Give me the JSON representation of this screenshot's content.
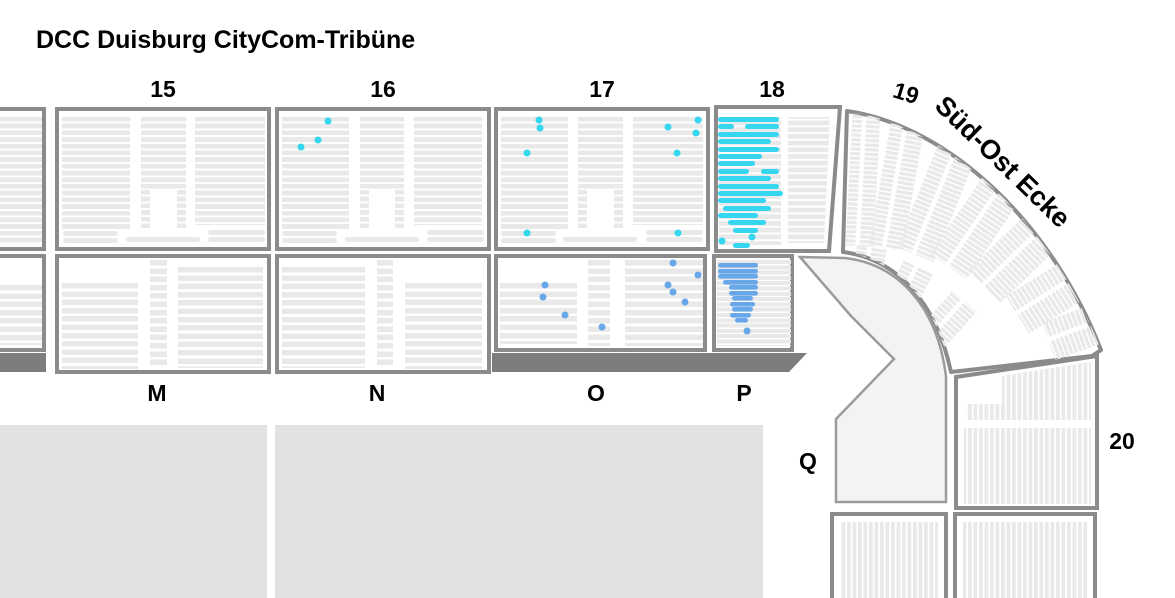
{
  "title": "DCC Duisburg CityCom-Tribüne",
  "section_labels": {
    "s15": "15",
    "s16": "16",
    "s17": "17",
    "s18": "18",
    "s19": "19",
    "s20": "20"
  },
  "row_labels": {
    "m": "M",
    "n": "N",
    "o": "O",
    "p": "P",
    "q": "Q"
  },
  "corner_label": "Süd-Ost Ecke",
  "colors": {
    "available": "#35d6ef",
    "selected": "#68a7e8",
    "seat": "#e9e9e9",
    "border": "#8b8b8b",
    "walkway": "#7d7d7d",
    "field": "#e2e2e2",
    "concourse": "#f3f3f3"
  },
  "seat_highlights": {
    "cyan_rows": [
      [
        718,
        117,
        61
      ],
      [
        718,
        124,
        16
      ],
      [
        745,
        124,
        34
      ],
      [
        718,
        132,
        61
      ],
      [
        718,
        139,
        53
      ],
      [
        718,
        147,
        61
      ],
      [
        718,
        154,
        44
      ],
      [
        718,
        161,
        37
      ],
      [
        718,
        169,
        31
      ],
      [
        761,
        169,
        18
      ],
      [
        718,
        176,
        53
      ],
      [
        718,
        184,
        61
      ],
      [
        718,
        191,
        65
      ],
      [
        718,
        198,
        48
      ],
      [
        723,
        206,
        48
      ],
      [
        718,
        213,
        40
      ],
      [
        728,
        220,
        38
      ],
      [
        733,
        228,
        25
      ],
      [
        733,
        243,
        17
      ]
    ],
    "cyan_dots": [
      [
        328,
        121
      ],
      [
        318,
        140
      ],
      [
        301,
        147
      ],
      [
        539,
        120
      ],
      [
        540,
        128
      ],
      [
        527,
        153
      ],
      [
        668,
        127
      ],
      [
        698,
        120
      ],
      [
        696,
        133
      ],
      [
        677,
        153
      ],
      [
        527,
        233
      ],
      [
        678,
        233
      ],
      [
        752,
        237
      ],
      [
        722,
        241
      ]
    ],
    "blue_rows": [
      [
        718,
        263,
        40
      ],
      [
        718,
        269,
        40
      ],
      [
        718,
        274,
        40
      ],
      [
        723,
        280,
        35
      ],
      [
        729,
        285,
        29
      ],
      [
        729,
        291,
        29
      ],
      [
        732,
        296,
        21
      ],
      [
        730,
        302,
        25
      ],
      [
        732,
        307,
        21
      ],
      [
        730,
        313,
        21
      ],
      [
        735,
        318,
        13
      ]
    ],
    "blue_dots": [
      [
        545,
        285
      ],
      [
        543,
        297
      ],
      [
        565,
        315
      ],
      [
        602,
        327
      ],
      [
        673,
        263
      ],
      [
        698,
        275
      ],
      [
        668,
        285
      ],
      [
        673,
        292
      ],
      [
        685,
        302
      ],
      [
        747,
        331
      ]
    ]
  }
}
